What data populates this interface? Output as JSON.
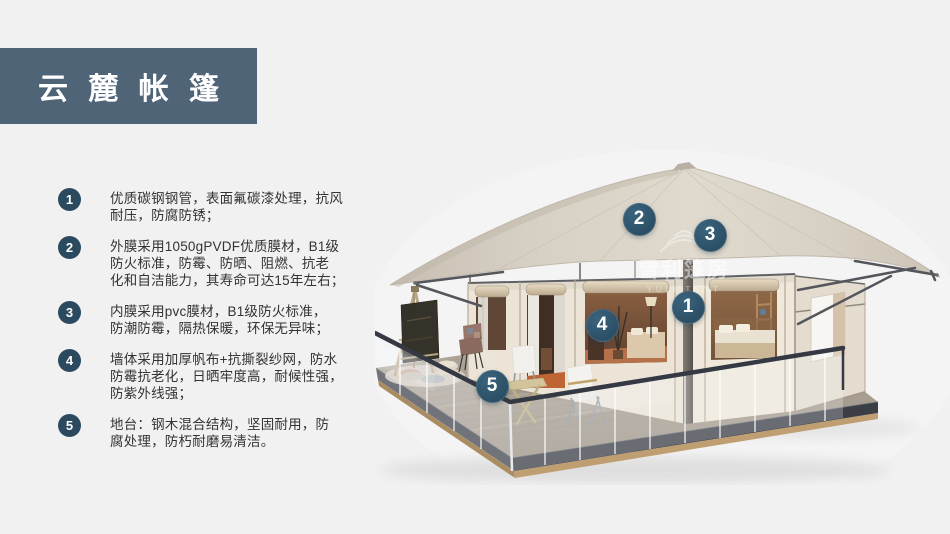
{
  "page": {
    "background": "#f1f1f2"
  },
  "title_block": {
    "title": "云 麓 帐 篷",
    "bg_color": "#506478",
    "text_color": "#ffffff"
  },
  "features": [
    {
      "num": "1",
      "text": "优质碳钢钢管，表面氟碳漆处理，抗风\n耐压，防腐防锈；"
    },
    {
      "num": "2",
      "text": "外膜采用1050gPVDF优质膜材，B1级\n防火标准，防霉、防晒、阻燃、抗老\n化和自洁能力，其寿命可达15年左右；"
    },
    {
      "num": "3",
      "text": "内膜采用pvc膜材，B1级防火标准，\n防潮防霉，隔热保暖，环保无异味；"
    },
    {
      "num": "4",
      "text": "墙体采用加厚帆布+抗撕裂纱网，防水\n防霉抗老化，日晒牢度高，耐候性强，\n防紫外线强；"
    },
    {
      "num": "5",
      "text": "地台：钢木混合结构，坚固耐用，防\n腐处理，防朽耐磨易清洁。"
    }
  ],
  "feature_badge_color": "#2c4a5f",
  "tent": {
    "marker_color": "#2e5670",
    "markers": [
      {
        "num": "1",
        "x": 687,
        "y": 306
      },
      {
        "num": "2",
        "x": 638,
        "y": 218
      },
      {
        "num": "3",
        "x": 709,
        "y": 234
      },
      {
        "num": "4",
        "x": 601,
        "y": 324
      },
      {
        "num": "5",
        "x": 491,
        "y": 385
      }
    ],
    "watermark": {
      "cn": "雪利篷房",
      "en": "YULI TENT"
    }
  }
}
